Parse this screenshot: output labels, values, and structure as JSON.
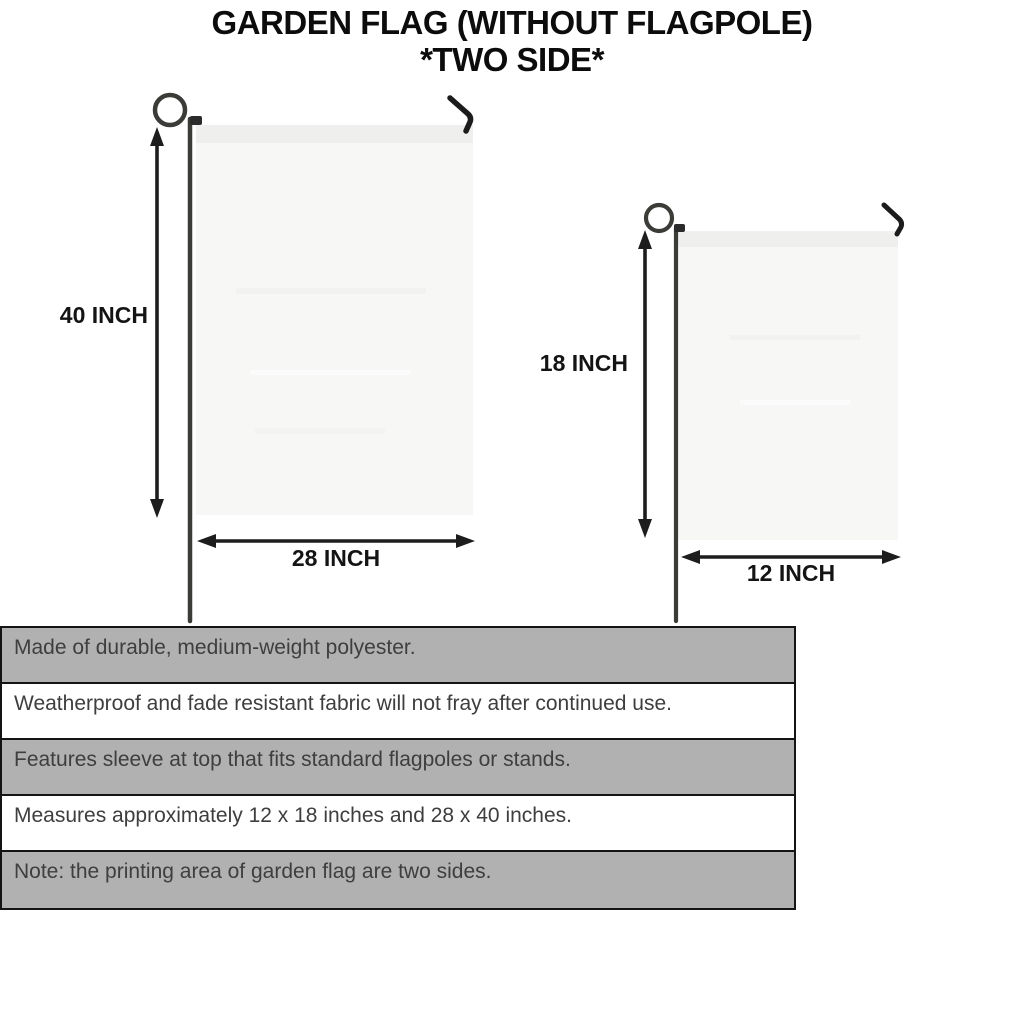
{
  "title": {
    "line1": "GARDEN FLAG (WITHOUT FLAGPOLE)",
    "line2": "*TWO SIDE*"
  },
  "diagram": {
    "large_flag": {
      "height_label": "40 INCH",
      "width_label": "28 INCH"
    },
    "small_flag": {
      "height_label": "18 INCH",
      "width_label": "12 INCH"
    }
  },
  "features": [
    "Made of durable, medium-weight polyester.",
    "Weatherproof and fade resistant fabric will not fray after continued use.",
    "Features sleeve at top that fits standard flagpoles or stands.",
    "Measures approximately 12 x 18 inches and 28 x 40 inches.",
    "Note: the printing area of garden flag are two sides."
  ],
  "colors": {
    "row_gray": "#b1b1b1",
    "row_white": "#ffffff",
    "table_border": "#141414",
    "body_text": "#3e3e3e",
    "title_text": "#0c0c0c",
    "flag_fill": "#f7f7f6",
    "flag_sleeve": "#efefee",
    "pole": "#3b3b38",
    "arrow": "#1d1d1d"
  }
}
